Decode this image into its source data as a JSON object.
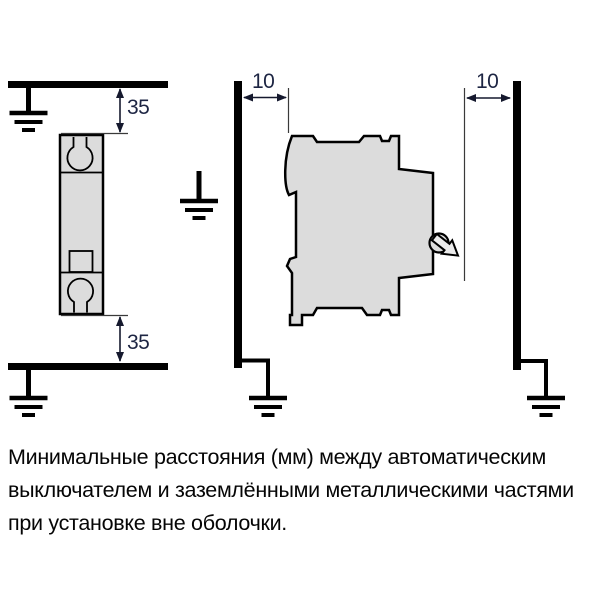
{
  "diagram": {
    "description_symbols": [
      "earth-ground-symbol",
      "wall-bar",
      "dimension-arrow"
    ],
    "front_view_panel": {
      "dim_top_mm": "35",
      "dim_bottom_mm": "35"
    },
    "side_view_panel": {
      "dim_left_mm": "10",
      "dim_right_mm": "10"
    }
  },
  "caption": {
    "lines": [
      "Минимальные расстояния (мм) между автоматическим",
      "выключателем и заземлёнными металлическими частями",
      "при установке вне оболочки."
    ]
  },
  "colors": {
    "background": "#ffffff",
    "breaker_body_fill": "#dcdcdc",
    "outline": "#000000",
    "dimension_text": "#1d2543",
    "caption_text": "#050505"
  }
}
